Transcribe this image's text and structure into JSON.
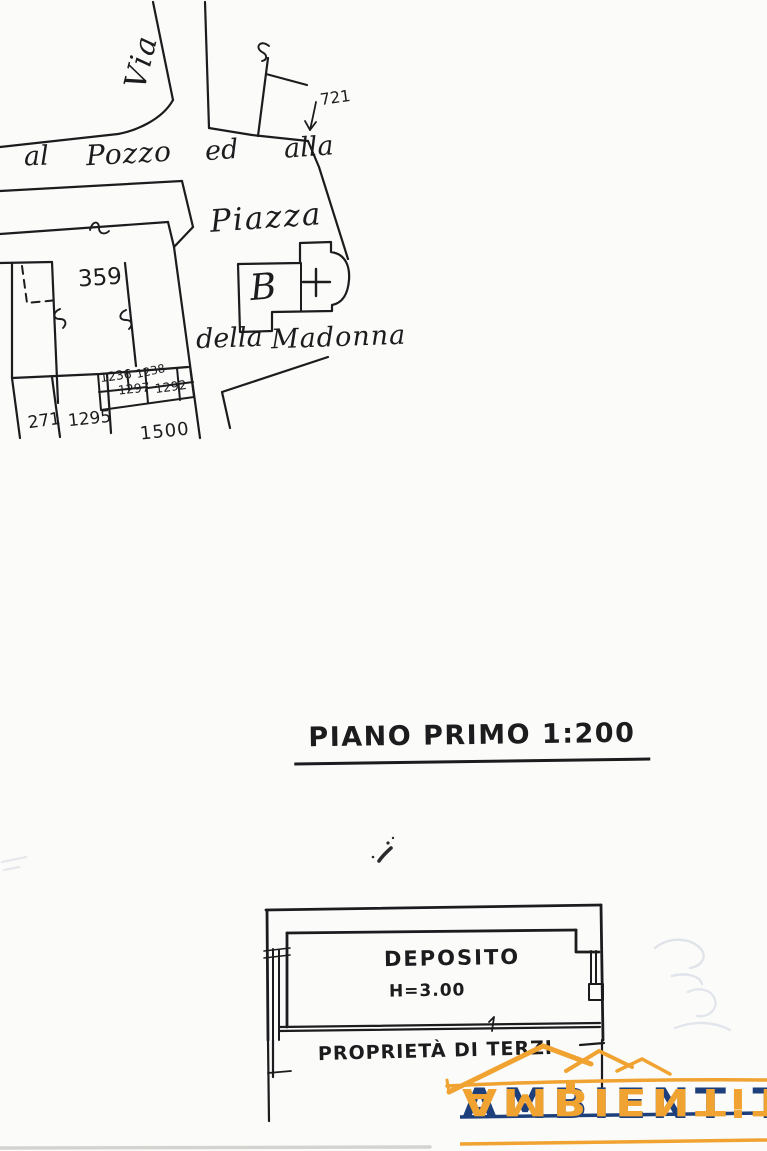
{
  "page": {
    "background": "#fbfbf9",
    "ink": "#1c1c1e"
  },
  "map": {
    "street_via": "Via",
    "street_al": "al",
    "street_pozzo": "Pozzo",
    "street_ed": "ed",
    "street_alla": "alla",
    "piazza": "Piazza",
    "della": "della",
    "madonna": "Madonna",
    "church_letter": "B",
    "parcels": {
      "p359": "359",
      "p721": "721",
      "p1236": "1236",
      "p1238": "1238",
      "p1297": "1297",
      "p1292": "1292",
      "p271": "271",
      "p1295": "1295",
      "p1500": "1500"
    }
  },
  "title": {
    "text": "PIANO PRIMO 1:200"
  },
  "floor_plan": {
    "room_label": "DEPOSITO",
    "height_label": "H=3.00",
    "boundary_label": "PROPRIETÀ DI TERZI"
  },
  "logo": {
    "text_main": "AMBIENT",
    "separator": ":",
    "text_end": "T",
    "navy": "#1d3f7c",
    "orange": "#f0a331"
  }
}
